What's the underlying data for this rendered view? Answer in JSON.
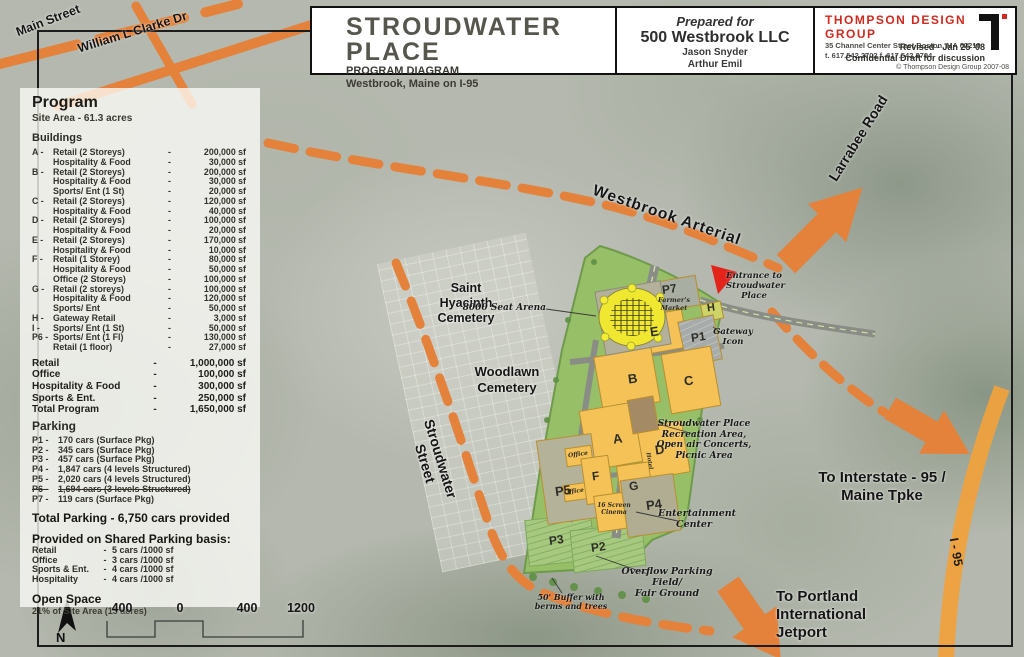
{
  "misc": {
    "dash": "-"
  },
  "colors": {
    "road_orange": "#E4813A",
    "highway_orange": "#F1A13C",
    "firm_red": "#CF2A20",
    "entrance_red": "#E3241B",
    "building_yellow": "#F4C257",
    "site_green": "#97BF68"
  },
  "title_block": {
    "title": "STROUDWATER PLACE",
    "subtitle": "PROGRAM DIAGRAM",
    "location": "Westbrook, Maine on I-95",
    "prepared_for_label": "Prepared for",
    "client": "500 Westbrook LLC",
    "contact1": "Jason Snyder",
    "contact2": "Arthur Emil",
    "firm_name": "THOMPSON DESIGN GROUP",
    "firm_address": "35 Channel Center Street Boston, MA 02210",
    "firm_phones": "t. 617.542.2702   f. 617.542.2704",
    "revised": "Revised - Jan 25 '08",
    "confidential": "Confidential Draft for discussion",
    "copyright": "© Thompson Design Group 2007-08"
  },
  "legend": {
    "heading": "Program",
    "site_area": "Site Area - 61.3 acres",
    "buildings_heading": "Buildings",
    "building_rows": [
      {
        "key": "A -",
        "name": "Retail (2 Storeys)",
        "value": "200,000 sf"
      },
      {
        "key": "",
        "name": "Hospitality & Food",
        "value": "30,000 sf"
      },
      {
        "key": "B -",
        "name": "Retail (2 Storeys)",
        "value": "200,000 sf"
      },
      {
        "key": "",
        "name": "Hospitality & Food",
        "value": "30,000 sf"
      },
      {
        "key": "",
        "name": "Sports/ Ent (1 St)",
        "value": "20,000 sf"
      },
      {
        "key": "C -",
        "name": "Retail (2 Storeys)",
        "value": "120,000 sf"
      },
      {
        "key": "",
        "name": "Hospitality & Food",
        "value": "40,000 sf"
      },
      {
        "key": "D -",
        "name": "Retail (2 Storeys)",
        "value": "100,000 sf"
      },
      {
        "key": "",
        "name": "Hospitality & Food",
        "value": "20,000 sf"
      },
      {
        "key": "E -",
        "name": "Retail (2 Storeys)",
        "value": "170,000 sf"
      },
      {
        "key": "",
        "name": "Hospitality & Food",
        "value": "10,000 sf"
      },
      {
        "key": "F -",
        "name": "Retail (1 Storey)",
        "value": "80,000 sf"
      },
      {
        "key": "",
        "name": "Hospitality & Food",
        "value": "50,000 sf"
      },
      {
        "key": "",
        "name": "Office (2 Storeys)",
        "value": "100,000 sf"
      },
      {
        "key": "G -",
        "name": "Retail (2 storeys)",
        "value": "100,000 sf"
      },
      {
        "key": "",
        "name": "Hospitality & Food",
        "value": "120,000 sf"
      },
      {
        "key": "",
        "name": "Sports/ Ent",
        "value": "50,000 sf"
      },
      {
        "key": "H -",
        "name": "Gateway Retail",
        "value": "3,000 sf"
      },
      {
        "key": "I -",
        "name": "Sports/ Ent (1 St)",
        "value": "50,000 sf"
      },
      {
        "key": "P6 -",
        "name": "Sports/ Ent (1 Fl)",
        "value": "130,000 sf"
      },
      {
        "key": "",
        "name": "Retail (1 floor)",
        "value": "27,000 sf"
      }
    ],
    "total_rows": [
      {
        "name": "Retail",
        "value": "1,000,000 sf"
      },
      {
        "name": "Office",
        "value": "100,000 sf"
      },
      {
        "name": "Hospitality & Food",
        "value": "300,000 sf"
      },
      {
        "name": "Sports & Ent.",
        "value": "250,000 sf"
      },
      {
        "name": "Total Program",
        "value": "1,650,000 sf"
      }
    ],
    "parking_heading": "Parking",
    "parking_rows": [
      {
        "key": "P1 -",
        "value": "170 cars (Surface Pkg)"
      },
      {
        "key": "P2 -",
        "value": "345 cars (Surface Pkg)"
      },
      {
        "key": "P3 -",
        "value": "457 cars (Surface Pkg)"
      },
      {
        "key": "P4 -",
        "value": "1,847 cars (4 levels Structured)"
      },
      {
        "key": "P5 -",
        "value": "2,020 cars (4 levels Structured)"
      },
      {
        "key": "P6 -",
        "value": "1,694 cars (3 levels Structured)",
        "struck": true
      },
      {
        "key": "P7 -",
        "value": "119 cars (Surface Pkg)"
      }
    ],
    "total_parking": "Total Parking - 6,750 cars provided",
    "shared_heading": "Provided on Shared Parking basis:",
    "shared_rows": [
      {
        "name": "Retail",
        "value": "5 cars /1000 sf"
      },
      {
        "name": "Office",
        "value": "3 cars /1000 sf"
      },
      {
        "name": "Sports & Ent.",
        "value": "4 cars /1000 sf"
      },
      {
        "name": "Hospitality",
        "value": "4 cars /1000 sf"
      }
    ],
    "open_space_heading": "Open Space",
    "open_space": "21% of Site Area (13 acres)"
  },
  "scalebar": {
    "n1": "400",
    "n2": "0",
    "n3": "400",
    "n4": "1200",
    "north": "N"
  },
  "map": {
    "roads": {
      "main_street": "Main Street",
      "william_clarke": "William L Clarke Dr",
      "westbrook_arterial": "Westbrook Arterial",
      "larrabee": "Larrabee Road",
      "stroudwater_street": "Stroudwater Street",
      "i95": "I - 95"
    },
    "places": {
      "saint_hyacinth": "Saint\nHyacinth\nCemetery",
      "woodlawn": "Woodlawn\nCemetery",
      "to_interstate": "To Interstate - 95 /\nMaine Tpke",
      "to_portland": "To Portland\nInternational\nJetport"
    },
    "callouts": {
      "arena": "8000 Seat Arena",
      "entrance": "Entrance to\nStroudwater\nPlace",
      "gateway": "Gateway\nIcon",
      "recreation": "Stroudwater Place\nRecreation Area,\nOpen air Concerts,\nPicnic Area",
      "entertainment": "Entertainment\nCenter",
      "overflow": "Overflow Parking Field/\nFair Ground",
      "buffer": "50' Buffer with\nberms and trees"
    },
    "plan_labels": {
      "p7": "P7",
      "farmers": "Farmer's\nMarket",
      "e": "E",
      "h": "H",
      "p1": "P1",
      "b": "B",
      "c": "C",
      "a": "A",
      "d": "D",
      "p5": "P5",
      "f": "F",
      "g": "G",
      "p4": "P4",
      "p3": "P3",
      "p2": "P2",
      "office1": "Office",
      "office2": "Office",
      "hotel": "Hotel",
      "cinema": "16 Screen\nCinema"
    }
  }
}
